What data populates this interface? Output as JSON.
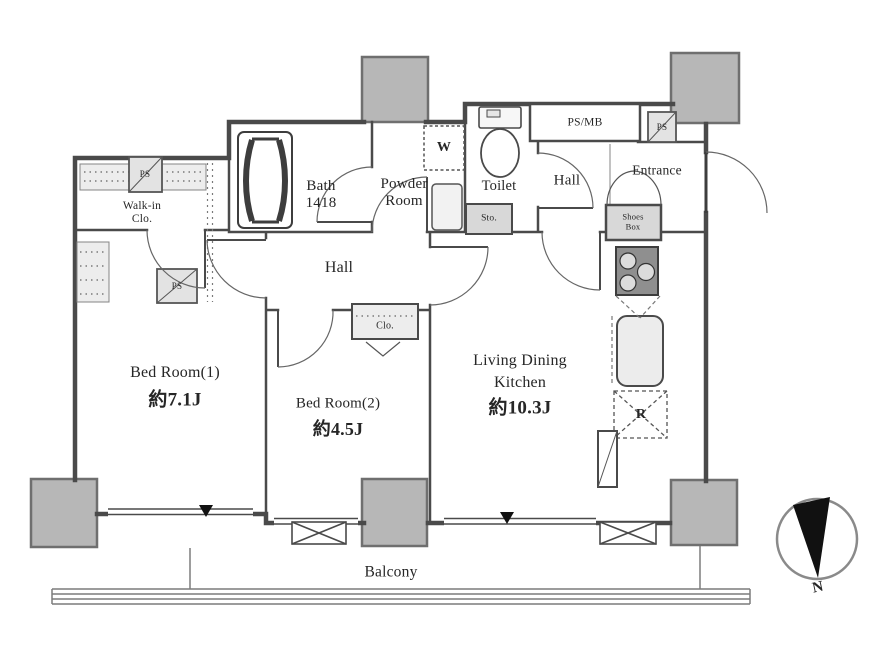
{
  "plan_labels": {
    "walk_in_closet_line1": "Walk-in",
    "walk_in_closet_line2": "Clo.",
    "bath_line1": "Bath",
    "bath_line2": "1418",
    "powder_room_line1": "Powder",
    "powder_room_line2": "Room",
    "toilet": "Toilet",
    "hall_upper": "Hall",
    "hall_middle": "Hall",
    "entrance": "Entrance",
    "bedroom1_name": "Bed Room(1)",
    "bedroom1_area": "約7.1J",
    "bedroom2_name": "Bed Room(2)",
    "bedroom2_area": "約4.5J",
    "ldk_name_line1": "Living Dining",
    "ldk_name_line2": "Kitchen",
    "ldk_area": "約10.3J",
    "balcony": "Balcony"
  },
  "fixture_labels": {
    "washer": "W",
    "storage": "Sto.",
    "shoes_box_line1": "Shoes",
    "shoes_box_line2": "Box",
    "closet": "Clo.",
    "refrigerator": "R",
    "ps_mb": "PS/MB",
    "ps_walkin_top": "PS",
    "ps_walkin_bottom": "PS",
    "ps_entrance": "PS"
  },
  "compass": {
    "north": "N"
  },
  "colors": {
    "wall": "#4a4a4a",
    "column_fill": "#b7b7b7",
    "shaded_fill": "#e0e0e0",
    "text": "#262626",
    "background": "#ffffff"
  }
}
